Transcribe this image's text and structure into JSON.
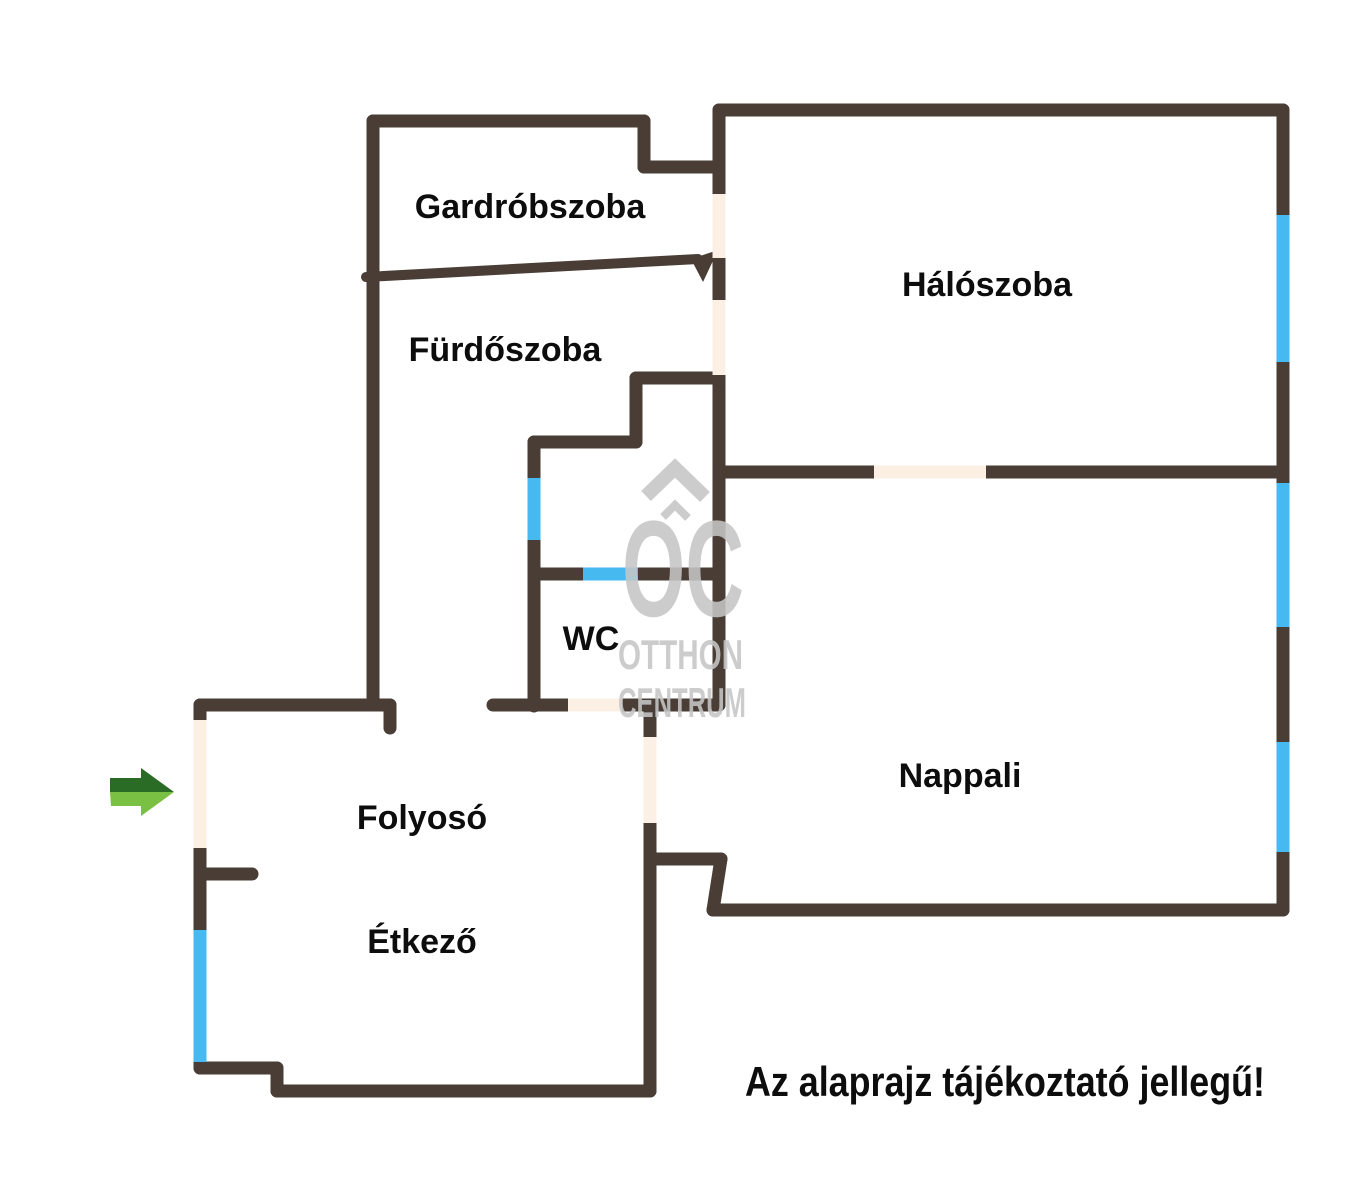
{
  "colors": {
    "wall": "#493d36",
    "door": "#fbf0e3",
    "window": "#47b9f1",
    "watermark": "#c6c6c6",
    "label": "#0d0d0d",
    "arrow_dark": "#2a6b26",
    "arrow_light": "#79c043",
    "background": "#ffffff"
  },
  "rooms": [
    {
      "id": "gardrobszoba",
      "label": "Gardróbszoba"
    },
    {
      "id": "furdoszoba",
      "label": "Fürdőszoba"
    },
    {
      "id": "haloszoba",
      "label": "Hálószoba"
    },
    {
      "id": "wc",
      "label": "WC"
    },
    {
      "id": "folyoso",
      "label": "Folyosó"
    },
    {
      "id": "etkezo",
      "label": "Étkező"
    },
    {
      "id": "nappali",
      "label": "Nappali"
    }
  ],
  "watermark": {
    "logo": "OC",
    "line1": "OTTHON",
    "line2": "CENTRUM"
  },
  "disclaimer": "Az alaprajz tájékoztató jellegű!"
}
